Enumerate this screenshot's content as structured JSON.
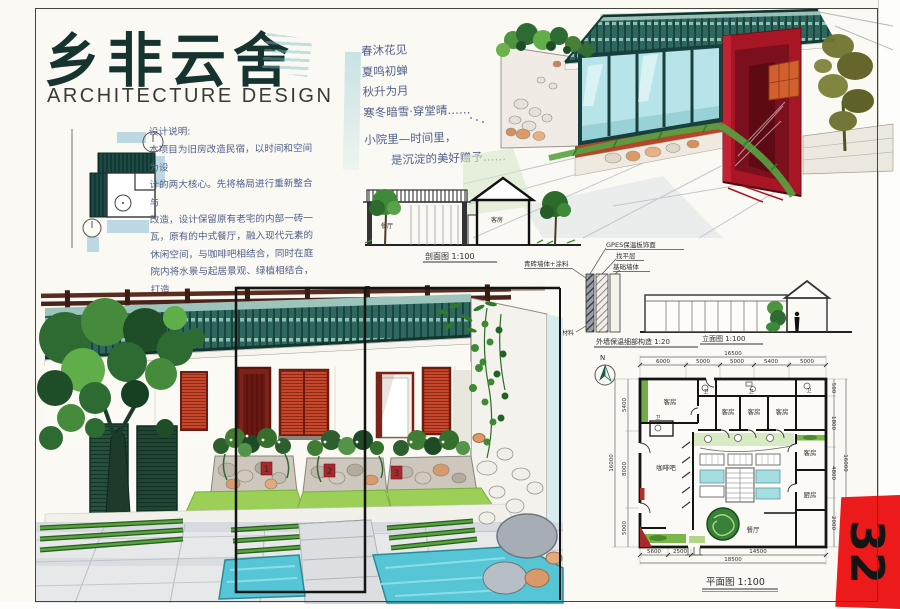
{
  "header": {
    "title": "乡非云舍",
    "subtitle": "ARCHITECTURE DESIGN"
  },
  "notes": {
    "heading": "设计说明:",
    "lines": [
      "本项目为旧房改造民宿，以时间和空间为设",
      "计的两大核心。先将格局进行重新整合与",
      "改造，设计保留原有老宅的内部一砖一",
      "瓦，原有的中式餐厅，融入现代元素的",
      "休闲空间，与咖啡吧相结合，同时在庭",
      "院内将水景与起居景观、绿植相结合，打造",
      "一个让客人在室外可进行日常活动，",
      "也将现代与传统老建筑相结合，对比",
      "体现不一样的视觉与空间感受。"
    ]
  },
  "poem": {
    "lines": [
      "春沐花见",
      "夏鸣初蝉",
      "秋升为月",
      "寒冬暗雪·穿堂晴……",
      "小院里—时间里，",
      "是沉淀的美好赠予……"
    ]
  },
  "section_drawing": {
    "caption": "剖面图 1:100",
    "room_left": "餐厅",
    "room_right": "客房"
  },
  "detail_drawing": {
    "wall_label": "青砖墙体+涂料",
    "layer_labels": [
      "GPES保温板饰面",
      "找平层",
      "基础墙体"
    ],
    "material_label": "饰面材料",
    "caption": "外墙保温细部构造 1:20"
  },
  "elevation": {
    "caption": "立面图 1:100"
  },
  "courtyard": {
    "door_tags": [
      "1",
      "2",
      "3"
    ]
  },
  "floor_plan": {
    "north_label": "N",
    "caption": "平面图 1:100",
    "rooms": {
      "guest": "客房",
      "cafe": "咖啡吧",
      "kitchen": "厨房",
      "dining": "餐厅",
      "wc": "卫"
    },
    "dims": {
      "top_total": "16500",
      "top": [
        "6000",
        "5000",
        "5000",
        "5400",
        "5000"
      ],
      "left": [
        "5400",
        "8000",
        "5000"
      ],
      "left_total": "16000",
      "right": [
        "500",
        "1800",
        "4800",
        "2000"
      ],
      "right_total": "16000",
      "bottom": [
        "5600",
        "2500",
        "14500"
      ],
      "bottom_total": "18500"
    }
  },
  "page_tab": {
    "number": "32"
  },
  "colors": {
    "title_ink": "#17332f",
    "hand_ink": "#51618a",
    "roof_teal": "#2e675e",
    "door_red": "#a81626",
    "accent_red": "#c6472c",
    "water_cyan": "#56c6d6",
    "foliage_green": "#2e6b33",
    "tab_red": "#ec1a1a"
  }
}
